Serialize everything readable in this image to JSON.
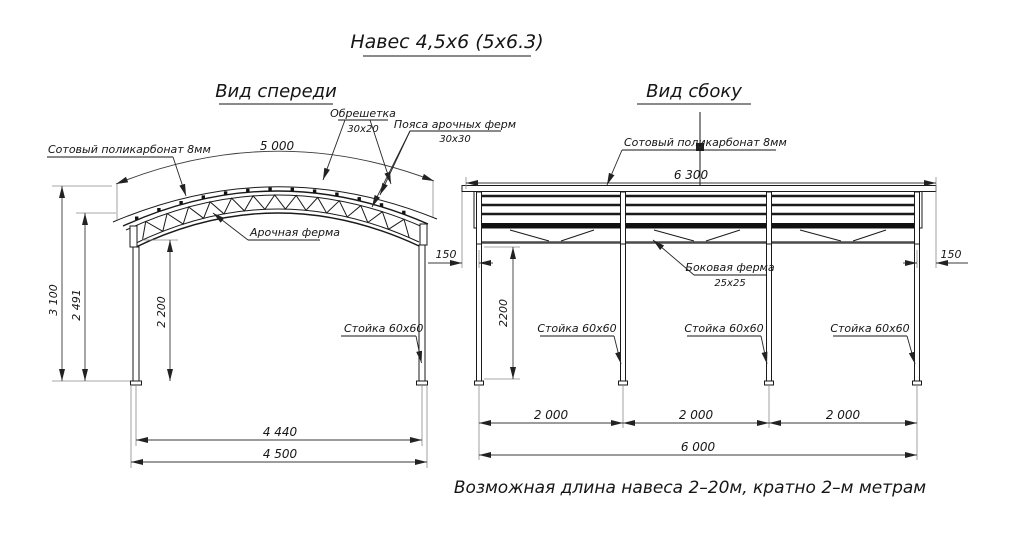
{
  "title": "Навес 4,5х6 (5х6.3)",
  "note": "Возможная длина навеса 2–20м, кратно 2–м метрам",
  "front_view": {
    "title": "Вид спереди",
    "labels": {
      "polycarbonate": "Сотовый поликарбонат 8мм",
      "sheathing": "Обрешетка",
      "sheathing_size": "30х20",
      "truss_chords": "Пояса арочных ферм",
      "truss_chords_size": "30х30",
      "arch_truss": "Арочная ферма",
      "post": "Стойка 60х60"
    },
    "dimensions": {
      "arc_width": "5 000",
      "total_height": "3 100",
      "eave_height": "2 491",
      "post_height": "2 200",
      "inner_width": "4 440",
      "outer_width": "4 500"
    }
  },
  "side_view": {
    "title": "Вид сбоку",
    "labels": {
      "polycarbonate": "Сотовый поликарбонат 8мм",
      "side_truss": "Боковая ферма",
      "side_truss_size": "25х25",
      "post_labels": [
        "Стойка 60х60",
        "Стойка 60х60",
        "Стойка 60х60"
      ]
    },
    "dimensions": {
      "roof_length": "6 300",
      "overhang_left": "150",
      "overhang_right": "150",
      "post_height": "2200",
      "bays": [
        "2 000",
        "2 000",
        "2 000"
      ],
      "total_length": "6 000"
    }
  }
}
